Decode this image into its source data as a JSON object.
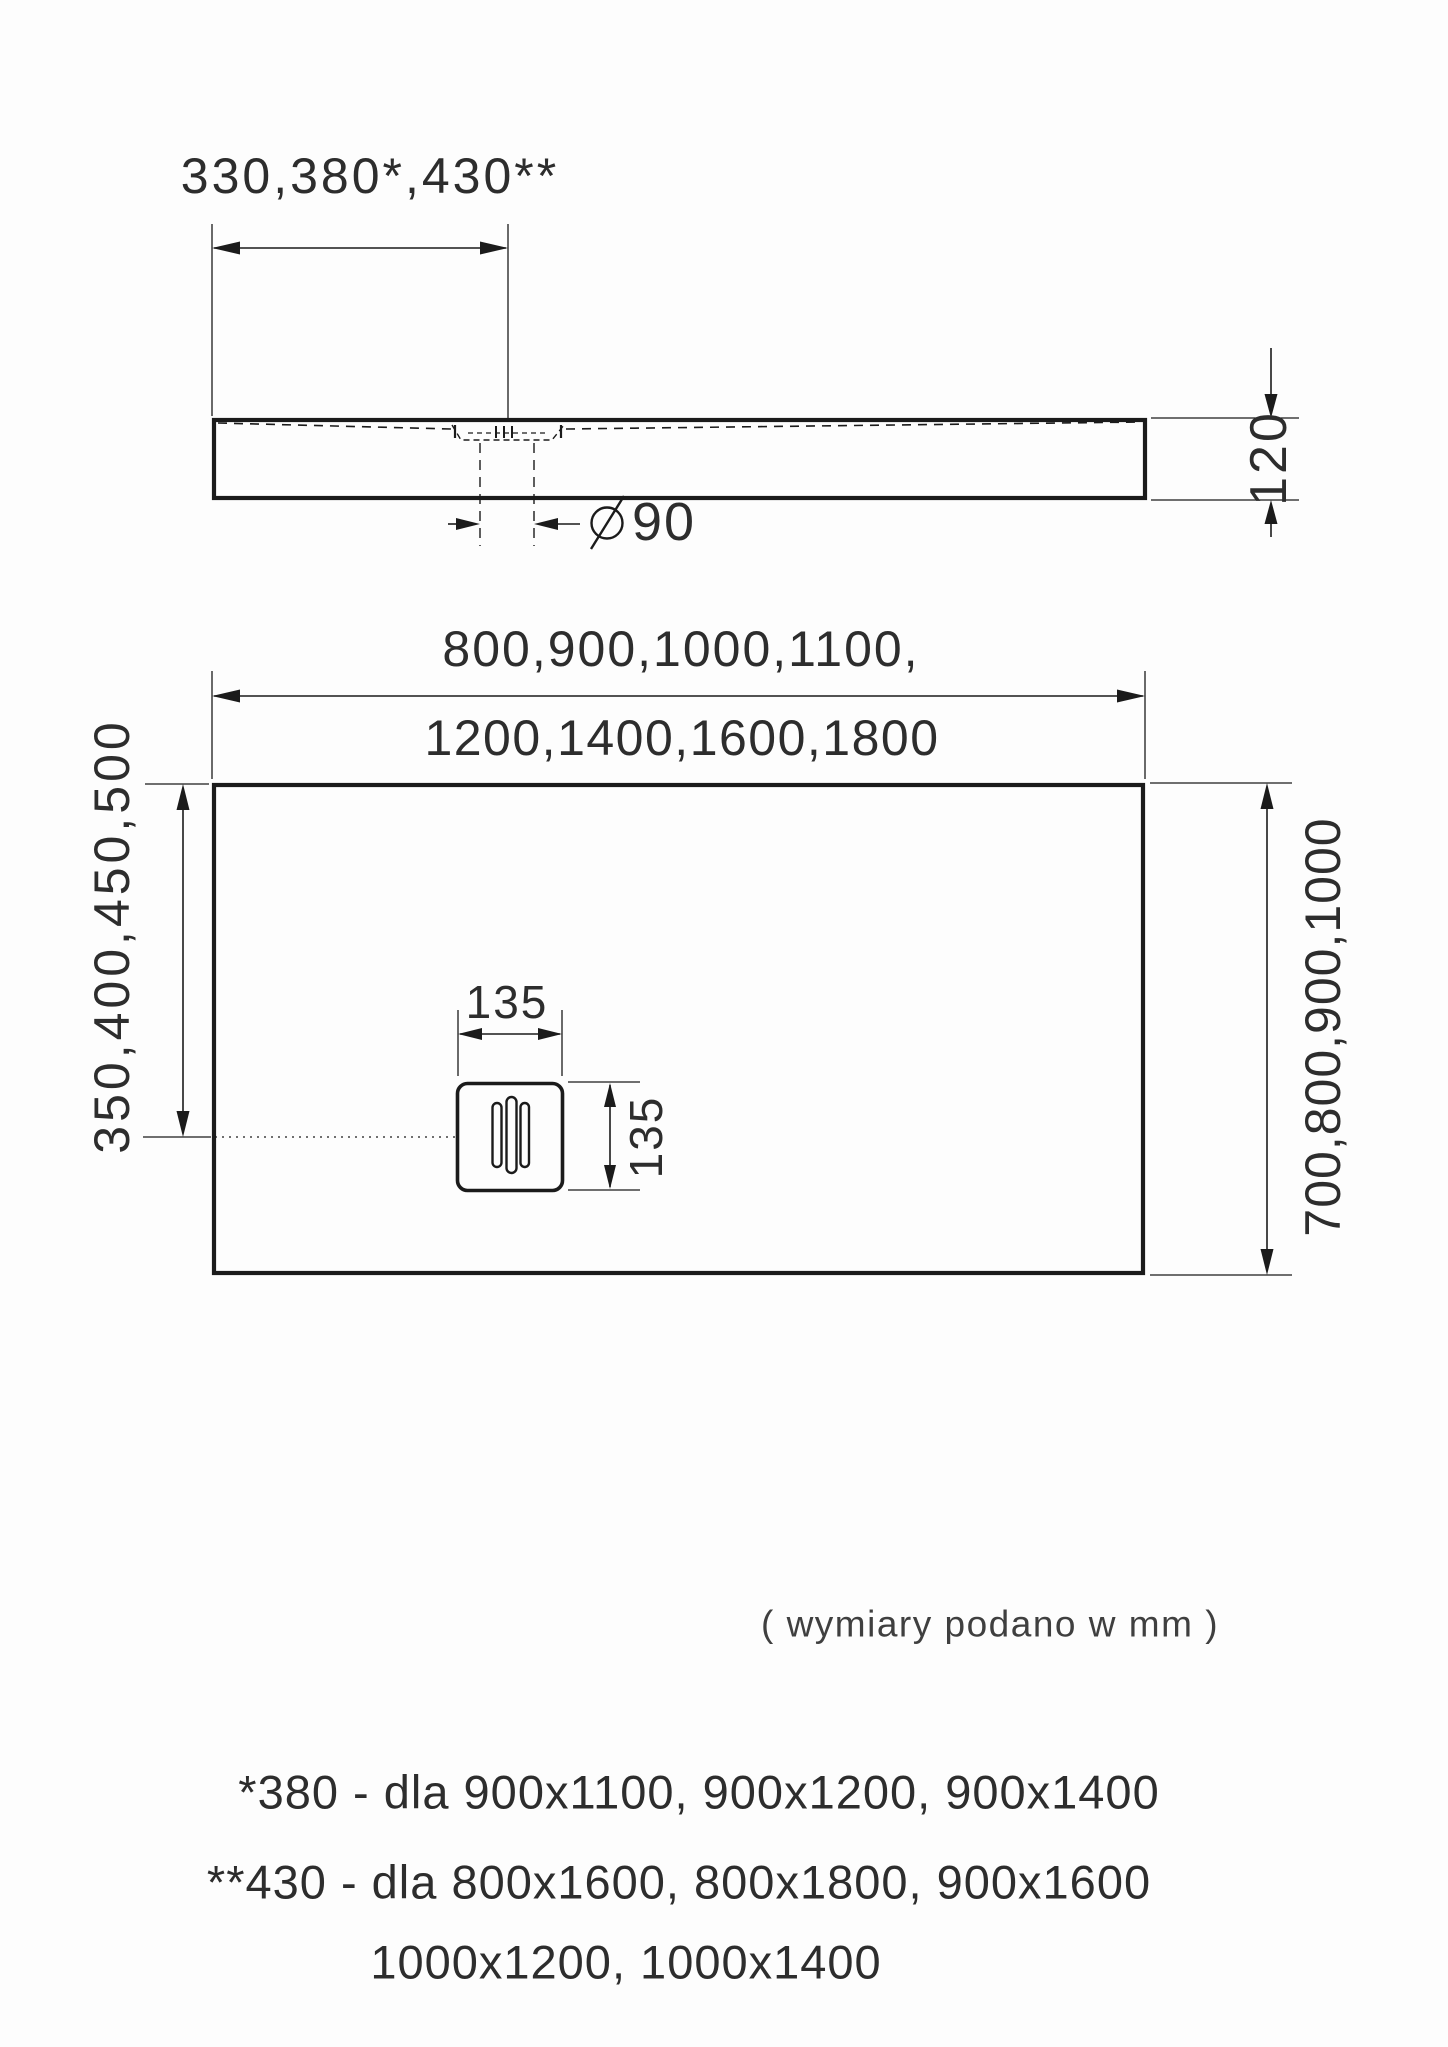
{
  "drawing": {
    "side_view": {
      "drain_offset_label": "330,380*,430**",
      "height_label": "120",
      "drain_diameter_symbol": "⌀",
      "drain_diameter_value": "90"
    },
    "top_view": {
      "width_label_line1": "800,900,1000,1100,",
      "width_label_line2": "1200,1400,1600,1800",
      "drain_offset_label": "350,400,450,500",
      "depth_label": "700,800,900,1000",
      "drain_width_label": "135",
      "drain_depth_label": "135"
    },
    "units_note": "( wymiary podano w mm )",
    "footnotes": [
      "*380 - dla 900x1100, 900x1200, 900x1400",
      "**430 - dla 800x1600, 800x1800, 900x1600",
      "1000x1200, 1000x1400"
    ]
  }
}
